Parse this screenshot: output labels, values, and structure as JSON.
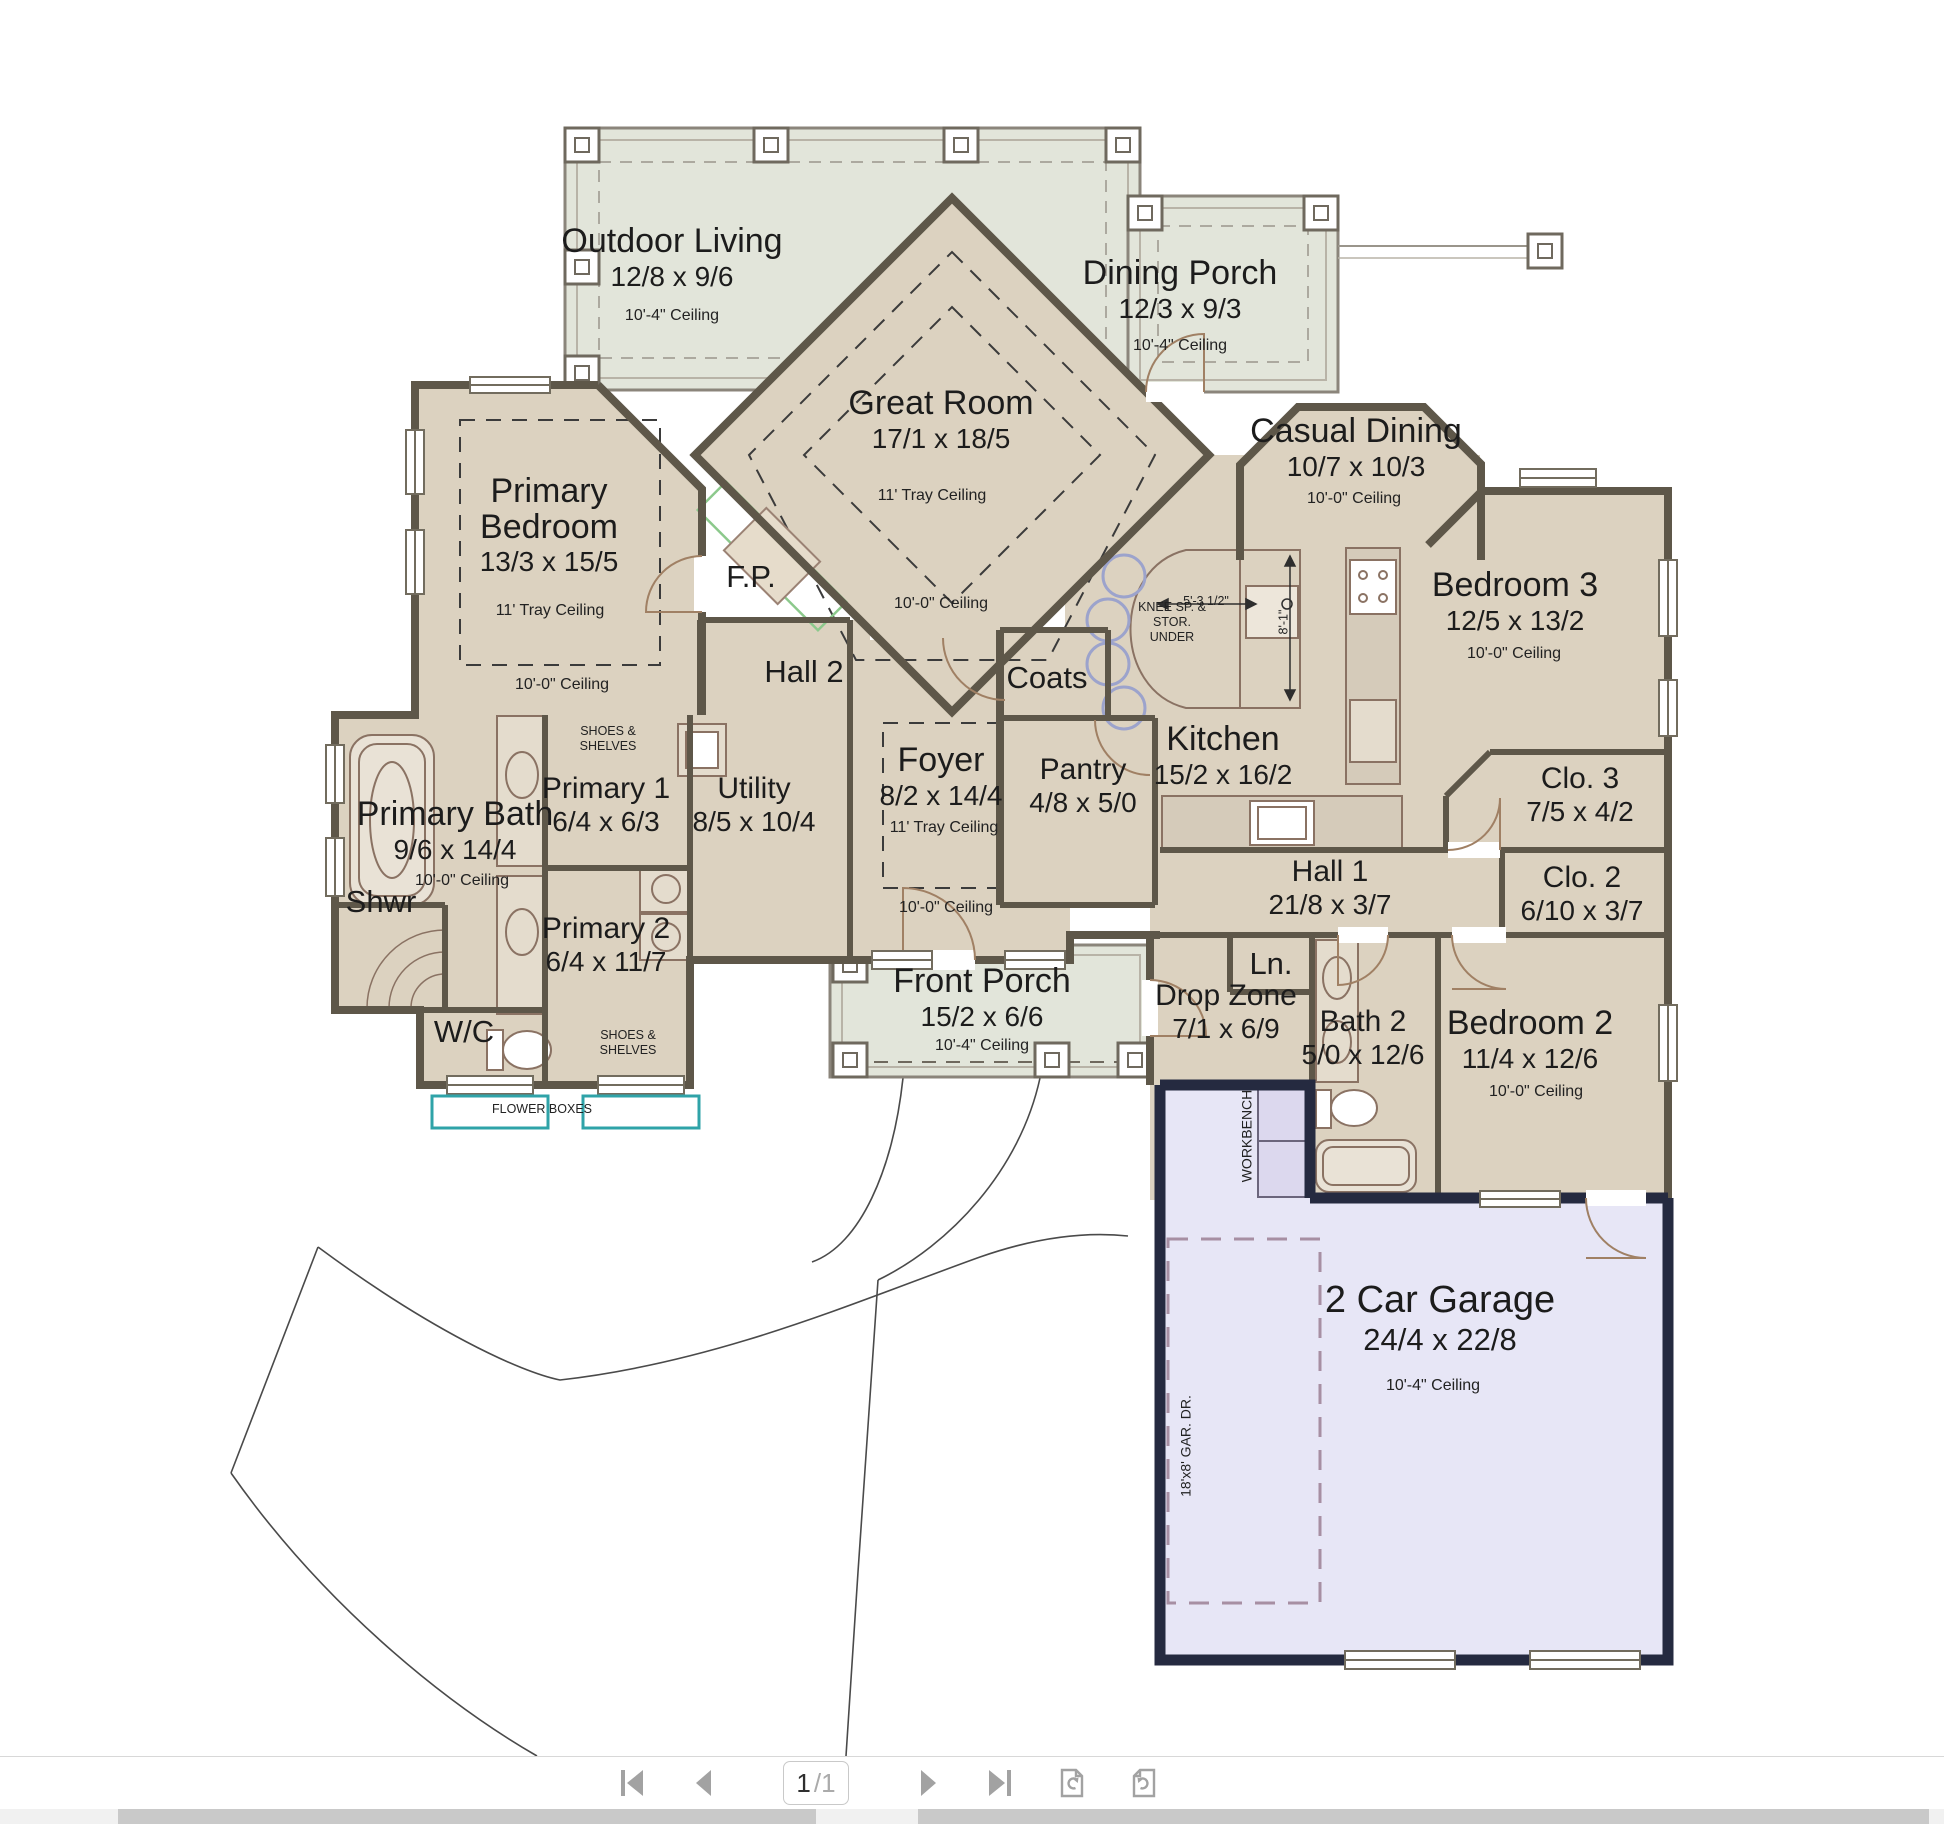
{
  "viewer": {
    "toolbar": {
      "page_current": "1",
      "page_total": "/1",
      "buttons": [
        "first-page",
        "previous-page",
        "page-number",
        "next-page",
        "last-page",
        "rotate-counterclockwise",
        "rotate-clockwise"
      ]
    }
  },
  "rooms": {
    "outdoor_living": {
      "name": "Outdoor Living",
      "dims": "12/8 x 9/6",
      "ceiling": "10'-4\" Ceiling"
    },
    "dining_porch": {
      "name": "Dining Porch",
      "dims": "12/3 x 9/3",
      "ceiling": "10'-4\" Ceiling"
    },
    "great_room": {
      "name": "Great Room",
      "dims": "17/1 x 18/5",
      "ceiling": "11' Tray Ceiling",
      "ceiling2": "10'-0\" Ceiling"
    },
    "casual_dining": {
      "name": "Casual Dining",
      "dims": "10/7 x 10/3",
      "ceiling": "10'-0\" Ceiling"
    },
    "primary_bedroom": {
      "name": "Primary Bedroom",
      "dims": "13/3 x 15/5",
      "ceiling": "11' Tray Ceiling",
      "ceiling2": "10'-0\" Ceiling"
    },
    "fireplace": {
      "name": "F.P."
    },
    "hall2": {
      "name": "Hall 2"
    },
    "coats": {
      "name": "Coats"
    },
    "kitchen": {
      "name": "Kitchen",
      "dims": "15/2 x 16/2"
    },
    "pantry": {
      "name": "Pantry",
      "dims": "4/8 x 5/0"
    },
    "foyer": {
      "name": "Foyer",
      "dims": "8/2 x 14/4",
      "ceiling": "11' Tray Ceiling",
      "ceiling2": "10'-0\" Ceiling"
    },
    "bedroom3": {
      "name": "Bedroom 3",
      "dims": "12/5 x 13/2",
      "ceiling": "10'-0\" Ceiling"
    },
    "clo3": {
      "name": "Clo. 3",
      "dims": "7/5 x 4/2"
    },
    "clo2": {
      "name": "Clo. 2",
      "dims": "6/10 x 3/7"
    },
    "hall1": {
      "name": "Hall 1",
      "dims": "21/8 x 3/7"
    },
    "primary_bath": {
      "name": "Primary Bath",
      "dims": "9/6 x 14/4",
      "ceiling": "10'-0\" Ceiling"
    },
    "primary1": {
      "name": "Primary 1",
      "dims": "6/4 x 6/3"
    },
    "utility": {
      "name": "Utility",
      "dims": "8/5 x 10/4"
    },
    "shower": {
      "name": "Shwr"
    },
    "primary2": {
      "name": "Primary 2",
      "dims": "6/4 x 11/7"
    },
    "wc": {
      "name": "W/C"
    },
    "front_porch": {
      "name": "Front Porch",
      "dims": "15/2 x 6/6",
      "ceiling": "10'-4\" Ceiling"
    },
    "drop_zone": {
      "name": "Drop Zone",
      "dims": "7/1 x 6/9"
    },
    "linen": {
      "name": "Ln."
    },
    "bath2": {
      "name": "Bath 2",
      "dims": "5/0 x 12/6"
    },
    "bedroom2": {
      "name": "Bedroom 2",
      "dims": "11/4 x 12/6",
      "ceiling": "10'-0\" Ceiling"
    },
    "garage": {
      "name": "2 Car Garage",
      "dims": "24/4 x 22/8",
      "ceiling": "10'-4\" Ceiling"
    }
  },
  "annotations": {
    "flower_boxes": "FLOWER BOXES",
    "shoes_shelves_1": "SHOES & SHELVES",
    "shoes_shelves_2": "SHOES & SHELVES",
    "workbench": "WORKBENCH",
    "garage_door": "18'x8' GAR. DR.",
    "knee_space": "KNEE SP. & STOR. UNDER",
    "island_width": "5'-3 1/2\"",
    "island_depth": "8'-1\""
  },
  "colors": {
    "room_fill": "#dcd2c0",
    "porch_fill": "#e2e5da",
    "garage_fill": "#e7e6f6",
    "wall": "#5e5749",
    "garage_wall": "#252a40",
    "flower_box_teal": "#2fa3a8",
    "fireplace_green": "#8cc98c",
    "stool_blue": "#9ca3cc",
    "garage_door_dash": "#a78fa3",
    "toolbar_icon": "#a2a2a2"
  }
}
